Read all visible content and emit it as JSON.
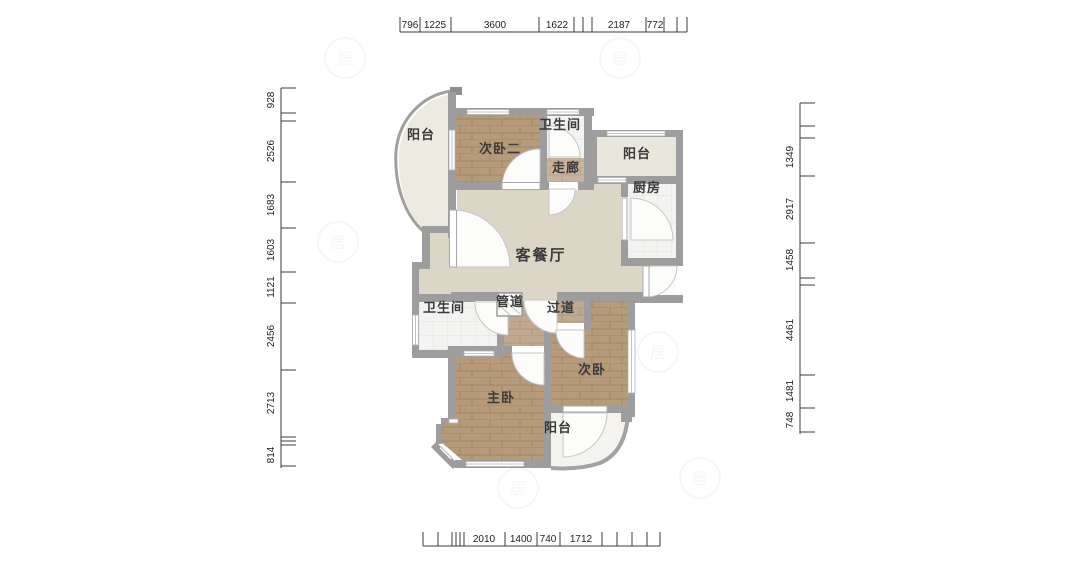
{
  "plan": {
    "rooms": [
      {
        "id": "balcony-top-left",
        "label": "阳台"
      },
      {
        "id": "bedroom-2",
        "label": "次卧二"
      },
      {
        "id": "bathroom-top",
        "label": "卫生间"
      },
      {
        "id": "corridor",
        "label": "走廊"
      },
      {
        "id": "balcony-top-right",
        "label": "阳台"
      },
      {
        "id": "kitchen",
        "label": "厨房"
      },
      {
        "id": "living-dining",
        "label": "客餐厅"
      },
      {
        "id": "bathroom-mid",
        "label": "卫生间"
      },
      {
        "id": "pipe-duct",
        "label": "管道"
      },
      {
        "id": "hallway",
        "label": "过道"
      },
      {
        "id": "bedroom-secondary",
        "label": "次卧"
      },
      {
        "id": "master-bedroom",
        "label": "主卧"
      },
      {
        "id": "balcony-bottom",
        "label": "阳台"
      }
    ],
    "dimensions": {
      "top": [
        "796",
        "1225",
        "3600",
        "1622",
        "2187",
        "772"
      ],
      "left": [
        "928",
        "2526",
        "1683",
        "1603",
        "1121",
        "2456",
        "2713",
        "814"
      ],
      "right": [
        "1349",
        "2917",
        "1458",
        "4461",
        "1481",
        "748"
      ],
      "bottom": [
        "2010",
        "1400",
        "740",
        "1712"
      ]
    },
    "colors": {
      "wall": "#9d9d9d",
      "wood_floor": "#b69b7b",
      "tile_floor": "#f3f4f2",
      "living_floor": "#dcd6c7",
      "balcony_floor": "#edebe1",
      "dimension_text": "#222222"
    }
  }
}
